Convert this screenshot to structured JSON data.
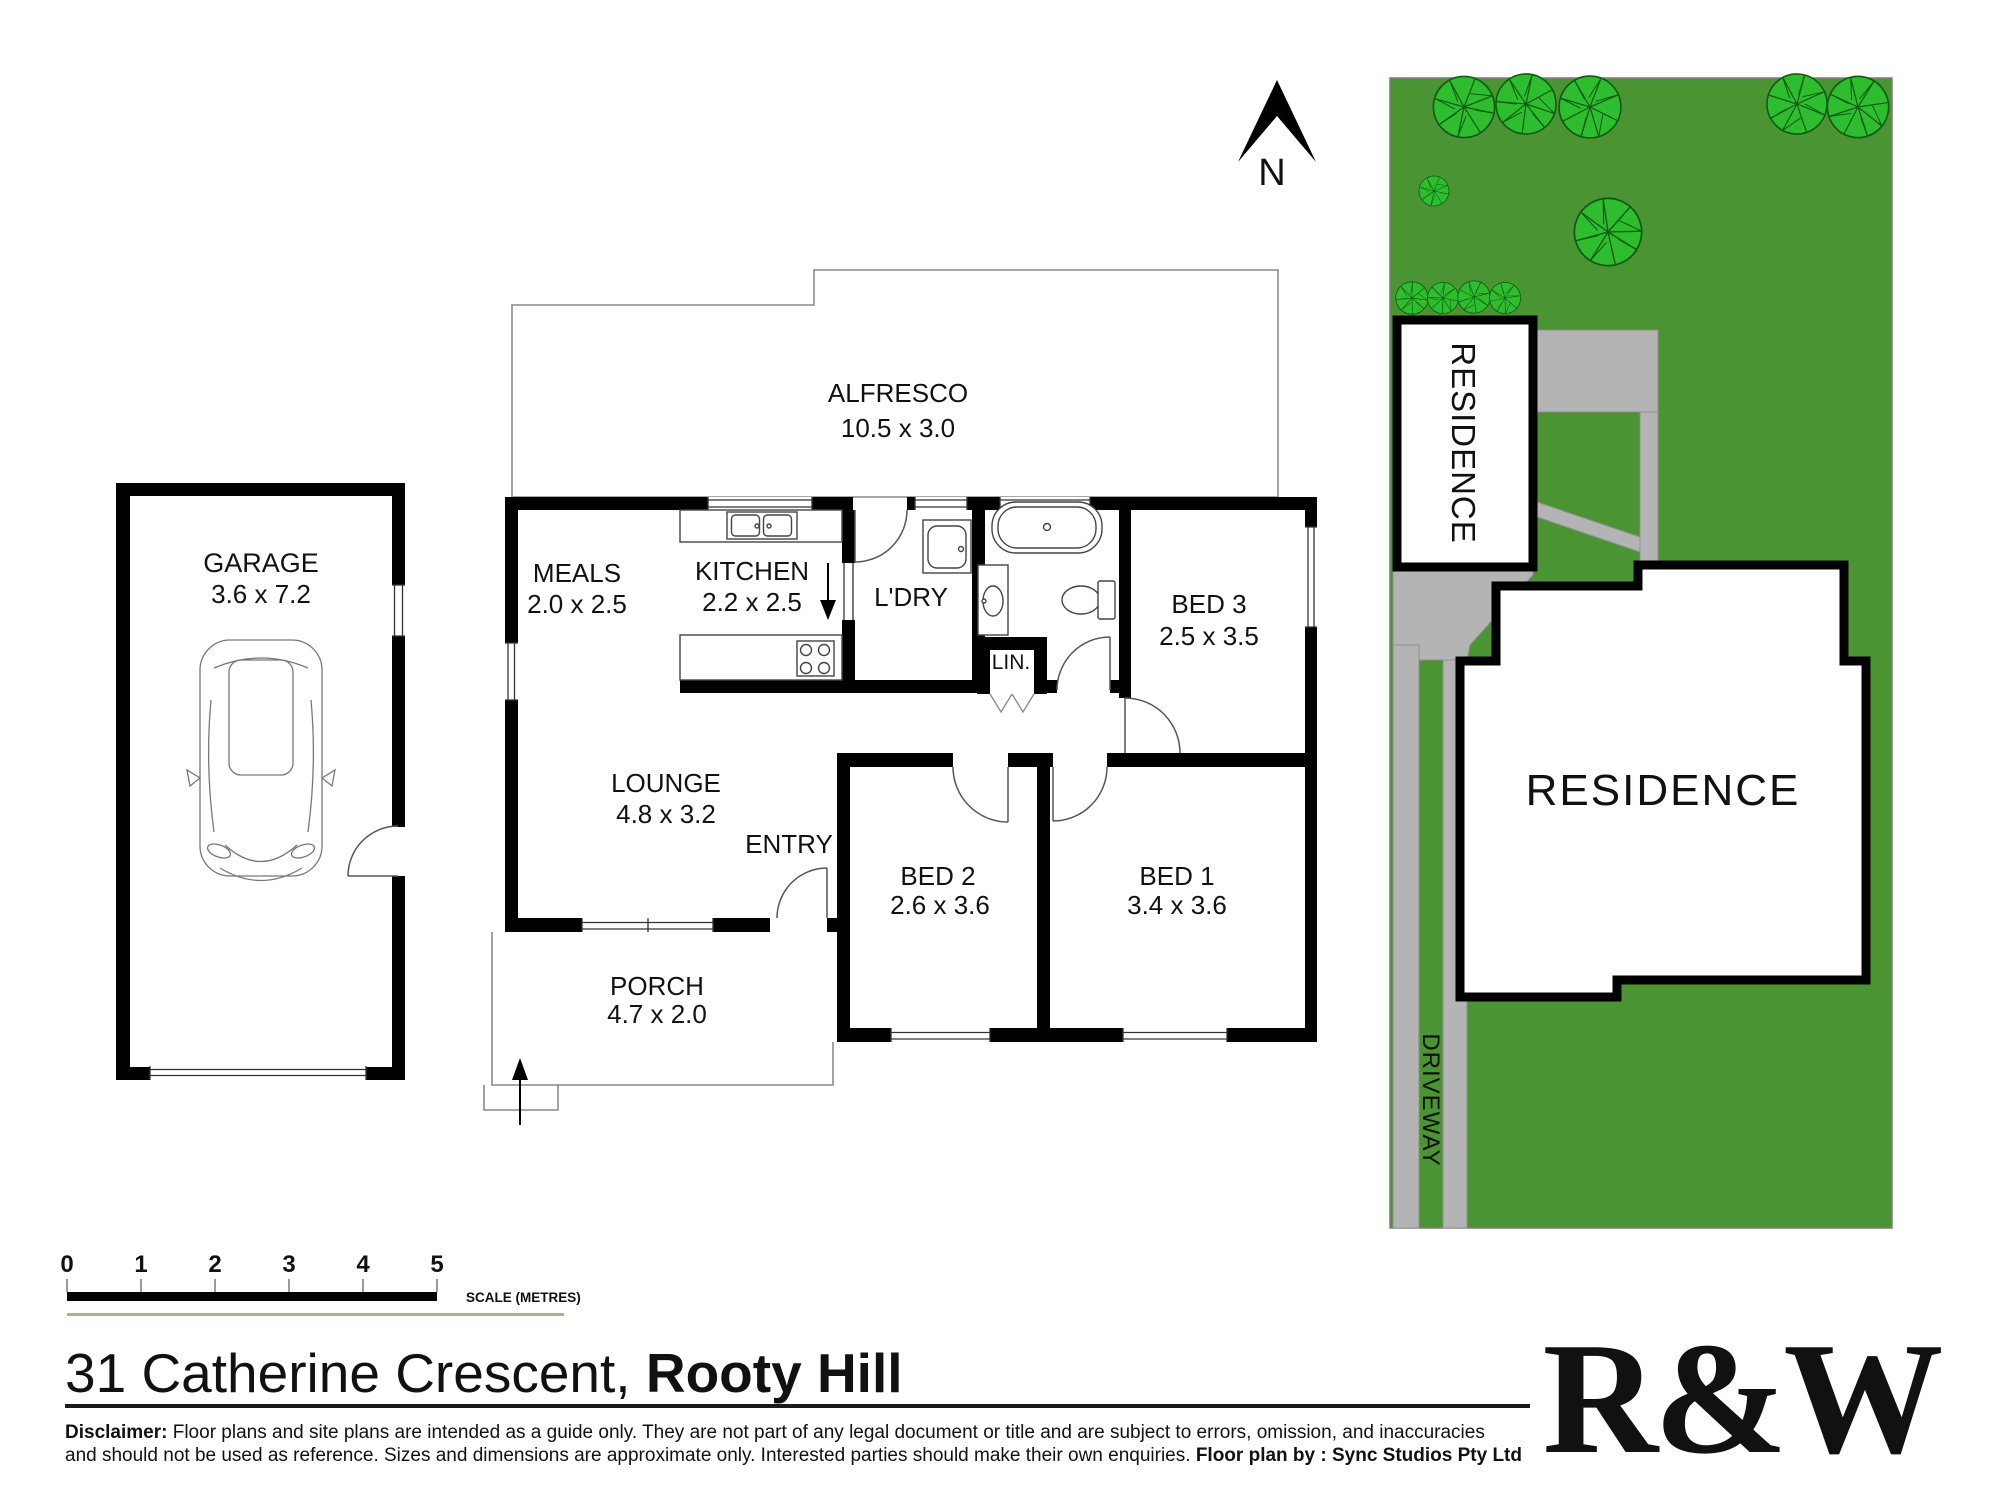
{
  "colors": {
    "wall": "#000000",
    "grass": "#4b9434",
    "tree_fill": "#2ebd2e",
    "tree_stroke": "#0f5c10",
    "paving": "#b4b4b4",
    "accent_red": "#d61f3d",
    "scale_tan": "#b5ac96"
  },
  "floor_plan": {
    "north_label": "N",
    "rooms": [
      {
        "name": "GARAGE",
        "dims": "3.6 x 7.2"
      },
      {
        "name": "ALFRESCO",
        "dims": "10.5 x 3.0"
      },
      {
        "name": "MEALS",
        "dims": "2.0 x 2.5"
      },
      {
        "name": "KITCHEN",
        "dims": "2.2 x 2.5"
      },
      {
        "name": "L'DRY",
        "dims": ""
      },
      {
        "name": "LIN.",
        "dims": ""
      },
      {
        "name": "BED 3",
        "dims": "2.5 x 3.5"
      },
      {
        "name": "LOUNGE",
        "dims": "4.8 x 3.2"
      },
      {
        "name": "ENTRY",
        "dims": ""
      },
      {
        "name": "BED 2",
        "dims": "2.6 x 3.6"
      },
      {
        "name": "BED 1",
        "dims": "3.4 x 3.6"
      },
      {
        "name": "PORCH",
        "dims": "4.7 x 2.0"
      }
    ]
  },
  "site_plan": {
    "residence_main_label": "RESIDENCE",
    "residence_neighbor_label": "RESIDENCE",
    "driveway_label": "DRIVEWAY"
  },
  "scale_bar": {
    "ticks": [
      "0",
      "1",
      "2",
      "3",
      "4",
      "5"
    ],
    "label": "SCALE (METRES)"
  },
  "footer": {
    "address_regular": "31 Catherine Crescent, ",
    "address_bold": "Rooty Hill",
    "disclaimer_bold": "Disclaimer:",
    "disclaimer_rest_line1": " Floor plans and site plans are intended as a guide only. They are not part of any legal document or title and are subject to errors, omission, and inaccuracies",
    "disclaimer_line2": "and should not be used as reference. Sizes and dimensions are approximate only. Interested parties should make their own enquiries. ",
    "disclaimer_line2_bold": "Floor plan by : Sync Studios Pty Ltd",
    "logo": "R&W"
  }
}
